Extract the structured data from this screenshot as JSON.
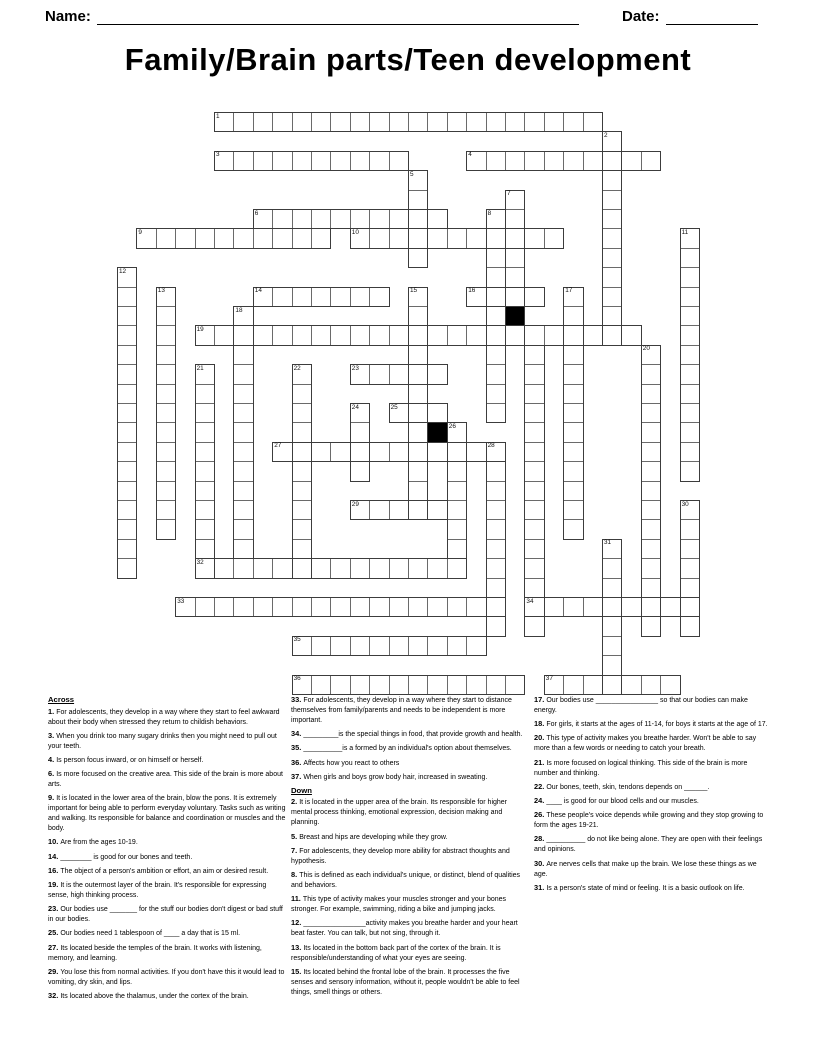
{
  "header": {
    "name_label": "Name:",
    "date_label": "Date:"
  },
  "title": "Family/Brain parts/Teen development",
  "grid": {
    "cell_px": 19.4,
    "origin_x": 117,
    "origin_y": 112,
    "words": [
      {
        "n": "1",
        "dir": "across",
        "col": 5,
        "row": 0,
        "len": 20
      },
      {
        "n": "2",
        "dir": "down",
        "col": 25,
        "row": 1,
        "len": 11
      },
      {
        "n": "3",
        "dir": "across",
        "col": 5,
        "row": 2,
        "len": 10
      },
      {
        "n": "4",
        "dir": "across",
        "col": 18,
        "row": 2,
        "len": 10
      },
      {
        "n": "5",
        "dir": "down",
        "col": 15,
        "row": 3,
        "len": 5
      },
      {
        "n": "6",
        "dir": "across",
        "col": 7,
        "row": 5,
        "len": 10
      },
      {
        "n": "7",
        "dir": "down",
        "col": 20,
        "row": 4,
        "len": 8
      },
      {
        "n": "8",
        "dir": "down",
        "col": 19,
        "row": 5,
        "len": 11
      },
      {
        "n": "9",
        "dir": "across",
        "col": 1,
        "row": 6,
        "len": 10
      },
      {
        "n": "10",
        "dir": "across",
        "col": 12,
        "row": 6,
        "len": 11
      },
      {
        "n": "11",
        "dir": "down",
        "col": 29,
        "row": 6,
        "len": 13
      },
      {
        "n": "12",
        "dir": "down",
        "col": 0,
        "row": 8,
        "len": 16
      },
      {
        "n": "13",
        "dir": "down",
        "col": 2,
        "row": 9,
        "len": 13
      },
      {
        "n": "14",
        "dir": "across",
        "col": 7,
        "row": 9,
        "len": 7
      },
      {
        "n": "15",
        "dir": "down",
        "col": 15,
        "row": 9,
        "len": 12
      },
      {
        "n": "16",
        "dir": "across",
        "col": 18,
        "row": 9,
        "len": 4
      },
      {
        "n": "17",
        "dir": "down",
        "col": 23,
        "row": 9,
        "len": 13
      },
      {
        "n": "18",
        "dir": "down",
        "col": 6,
        "row": 10,
        "len": 13
      },
      {
        "n": "19",
        "dir": "across",
        "col": 4,
        "row": 11,
        "len": 23
      },
      {
        "n": "20",
        "dir": "down",
        "col": 27,
        "row": 12,
        "len": 15
      },
      {
        "n": "",
        "dir": "down",
        "col": 21,
        "row": 12,
        "len": 15
      },
      {
        "n": "21",
        "dir": "down",
        "col": 4,
        "row": 13,
        "len": 11
      },
      {
        "n": "22",
        "dir": "down",
        "col": 9,
        "row": 13,
        "len": 11
      },
      {
        "n": "23",
        "dir": "across",
        "col": 12,
        "row": 13,
        "len": 5
      },
      {
        "n": "24",
        "dir": "down",
        "col": 12,
        "row": 15,
        "len": 4
      },
      {
        "n": "25",
        "dir": "across",
        "col": 14,
        "row": 15,
        "len": 3
      },
      {
        "n": "26",
        "dir": "down",
        "col": 17,
        "row": 16,
        "len": 7
      },
      {
        "n": "",
        "dir": "down",
        "col": 16,
        "row": 16,
        "len": 1
      },
      {
        "n": "27",
        "dir": "across",
        "col": 8,
        "row": 17,
        "len": 12
      },
      {
        "n": "28",
        "dir": "down",
        "col": 19,
        "row": 17,
        "len": 10
      },
      {
        "n": "29",
        "dir": "across",
        "col": 12,
        "row": 20,
        "len": 5
      },
      {
        "n": "30",
        "dir": "down",
        "col": 29,
        "row": 20,
        "len": 7
      },
      {
        "n": "31",
        "dir": "down",
        "col": 25,
        "row": 22,
        "len": 8
      },
      {
        "n": "32",
        "dir": "across",
        "col": 4,
        "row": 23,
        "len": 14
      },
      {
        "n": "33",
        "dir": "across",
        "col": 3,
        "row": 25,
        "len": 17
      },
      {
        "n": "34",
        "dir": "across",
        "col": 21,
        "row": 25,
        "len": 9
      },
      {
        "n": "35",
        "dir": "across",
        "col": 9,
        "row": 27,
        "len": 10
      },
      {
        "n": "36",
        "dir": "across",
        "col": 9,
        "row": 29,
        "len": 12
      },
      {
        "n": "37",
        "dir": "across",
        "col": 22,
        "row": 29,
        "len": 7
      }
    ],
    "black_cells": [
      {
        "col": 20,
        "row": 10
      },
      {
        "col": 16,
        "row": 16
      }
    ]
  },
  "clues": {
    "columns": [
      [
        {
          "h": "Across"
        },
        {
          "n": "1",
          "t": "For adolescents, they develop in a way where they start to feel awkward about their body when stressed they return to childish behaviors."
        },
        {
          "n": "3",
          "t": "When you drink too many sugary drinks then you might need to pull out your teeth."
        },
        {
          "n": "4",
          "t": "Is person focus inward, or on himself or herself."
        },
        {
          "n": "6",
          "t": "Is more focused on the creative area. This side of the brain is more about arts."
        },
        {
          "n": "9",
          "t": "It is located in the lower area of the brain, blow the pons. It is extremely important for being able to perform everyday voluntary. Tasks such as writing and walking. Its responsible for balance and coordination or muscles and the body."
        },
        {
          "n": "10",
          "t": "Are from the ages 10-19."
        },
        {
          "n": "14",
          "t": "________ is good for our bones and teeth."
        },
        {
          "n": "16",
          "t": "The object of a person's ambition or effort, an aim or desired result."
        },
        {
          "n": "19",
          "t": "It is the outermost layer of the brain. It's responsible for expressing sense, high thinking process."
        },
        {
          "n": "23",
          "t": "Our bodies use _______ for the stuff our bodies don't digest or bad stuff in our bodies."
        },
        {
          "n": "25",
          "t": "Our bodies need 1 tablespoon of ____ a day that is 15 ml."
        },
        {
          "n": "27",
          "t": "Its located beside the temples of the brain. It works with listening, memory, and learning."
        },
        {
          "n": "29",
          "t": "You lose this from normal activities. If you don't have this it would lead to vomiting, dry skin, and lips."
        },
        {
          "n": "32",
          "t": "Its located above the thalamus, under the cortex of the brain."
        }
      ],
      [
        {
          "n": "33",
          "t": "For adolescents, they develop in a way where they start to distance themselves from family/parents and needs to be independent is more important."
        },
        {
          "n": "34",
          "t": "_________is the special things in food, that provide growth and health."
        },
        {
          "n": "35",
          "t": "__________is a formed by an individual's option about themselves."
        },
        {
          "n": "36",
          "t": "Affects how you react to others"
        },
        {
          "n": "37",
          "t": "When girls and boys grow body hair, increased in sweating."
        },
        {
          "h": "Down"
        },
        {
          "n": "2",
          "t": "It is located in the upper area of the brain. Its responsible for higher mental process thinking, emotional expression, decision making and planning."
        },
        {
          "n": "5",
          "t": "Breast and hips are developing while they grow."
        },
        {
          "n": "7",
          "t": "For adolescents, they develop more ability for abstract thoughts and hypothesis."
        },
        {
          "n": "8",
          "t": "This is defined as each individual's unique, or distinct, blend of qualities and behaviors."
        },
        {
          "n": "11",
          "t": "This type of activity makes your muscles stronger and your bones stronger. For example, swimming, riding a bike and jumping jacks."
        },
        {
          "n": "12",
          "t": "________________activity makes you breathe harder and your heart beat faster. You can talk, but not sing, through it."
        },
        {
          "n": "13",
          "t": "Its located in the bottom back part of the cortex of the brain. It is responsible/understanding of what your eyes are seeing."
        },
        {
          "n": "15",
          "t": "Its located behind the frontal lobe of the brain. It processes the five senses and sensory information, without it, people wouldn't be able to feel things, smell things or others."
        }
      ],
      [
        {
          "n": "17",
          "t": "Our bodies use ________________ so that our bodies can make energy."
        },
        {
          "n": "18",
          "t": "For girls, it starts at the ages of 11-14, for boys it starts at the age of 17."
        },
        {
          "n": "20",
          "t": "This type of activity makes you breathe harder. Won't be able to say more than a few words or needing to catch your breath."
        },
        {
          "n": "21",
          "t": "Is more focused on logical thinking. This side of the brain is more number and thinking."
        },
        {
          "n": "22",
          "t": "Our bones, teeth, skin, tendons depends on ______."
        },
        {
          "n": "24",
          "t": "____ is good for our blood cells and our muscles."
        },
        {
          "n": "26",
          "t": "These people's voice depends while growing and they stop growing to form the ages 19-21."
        },
        {
          "n": "28",
          "t": "__________ do not like being alone. They are open with their feelings and opinions."
        },
        {
          "n": "30",
          "t": "Are nerves cells that make up the brain. We lose these things as we age."
        },
        {
          "n": "31",
          "t": "Is a person's state of mind or feeling. It is a basic outlook on life."
        }
      ]
    ]
  }
}
